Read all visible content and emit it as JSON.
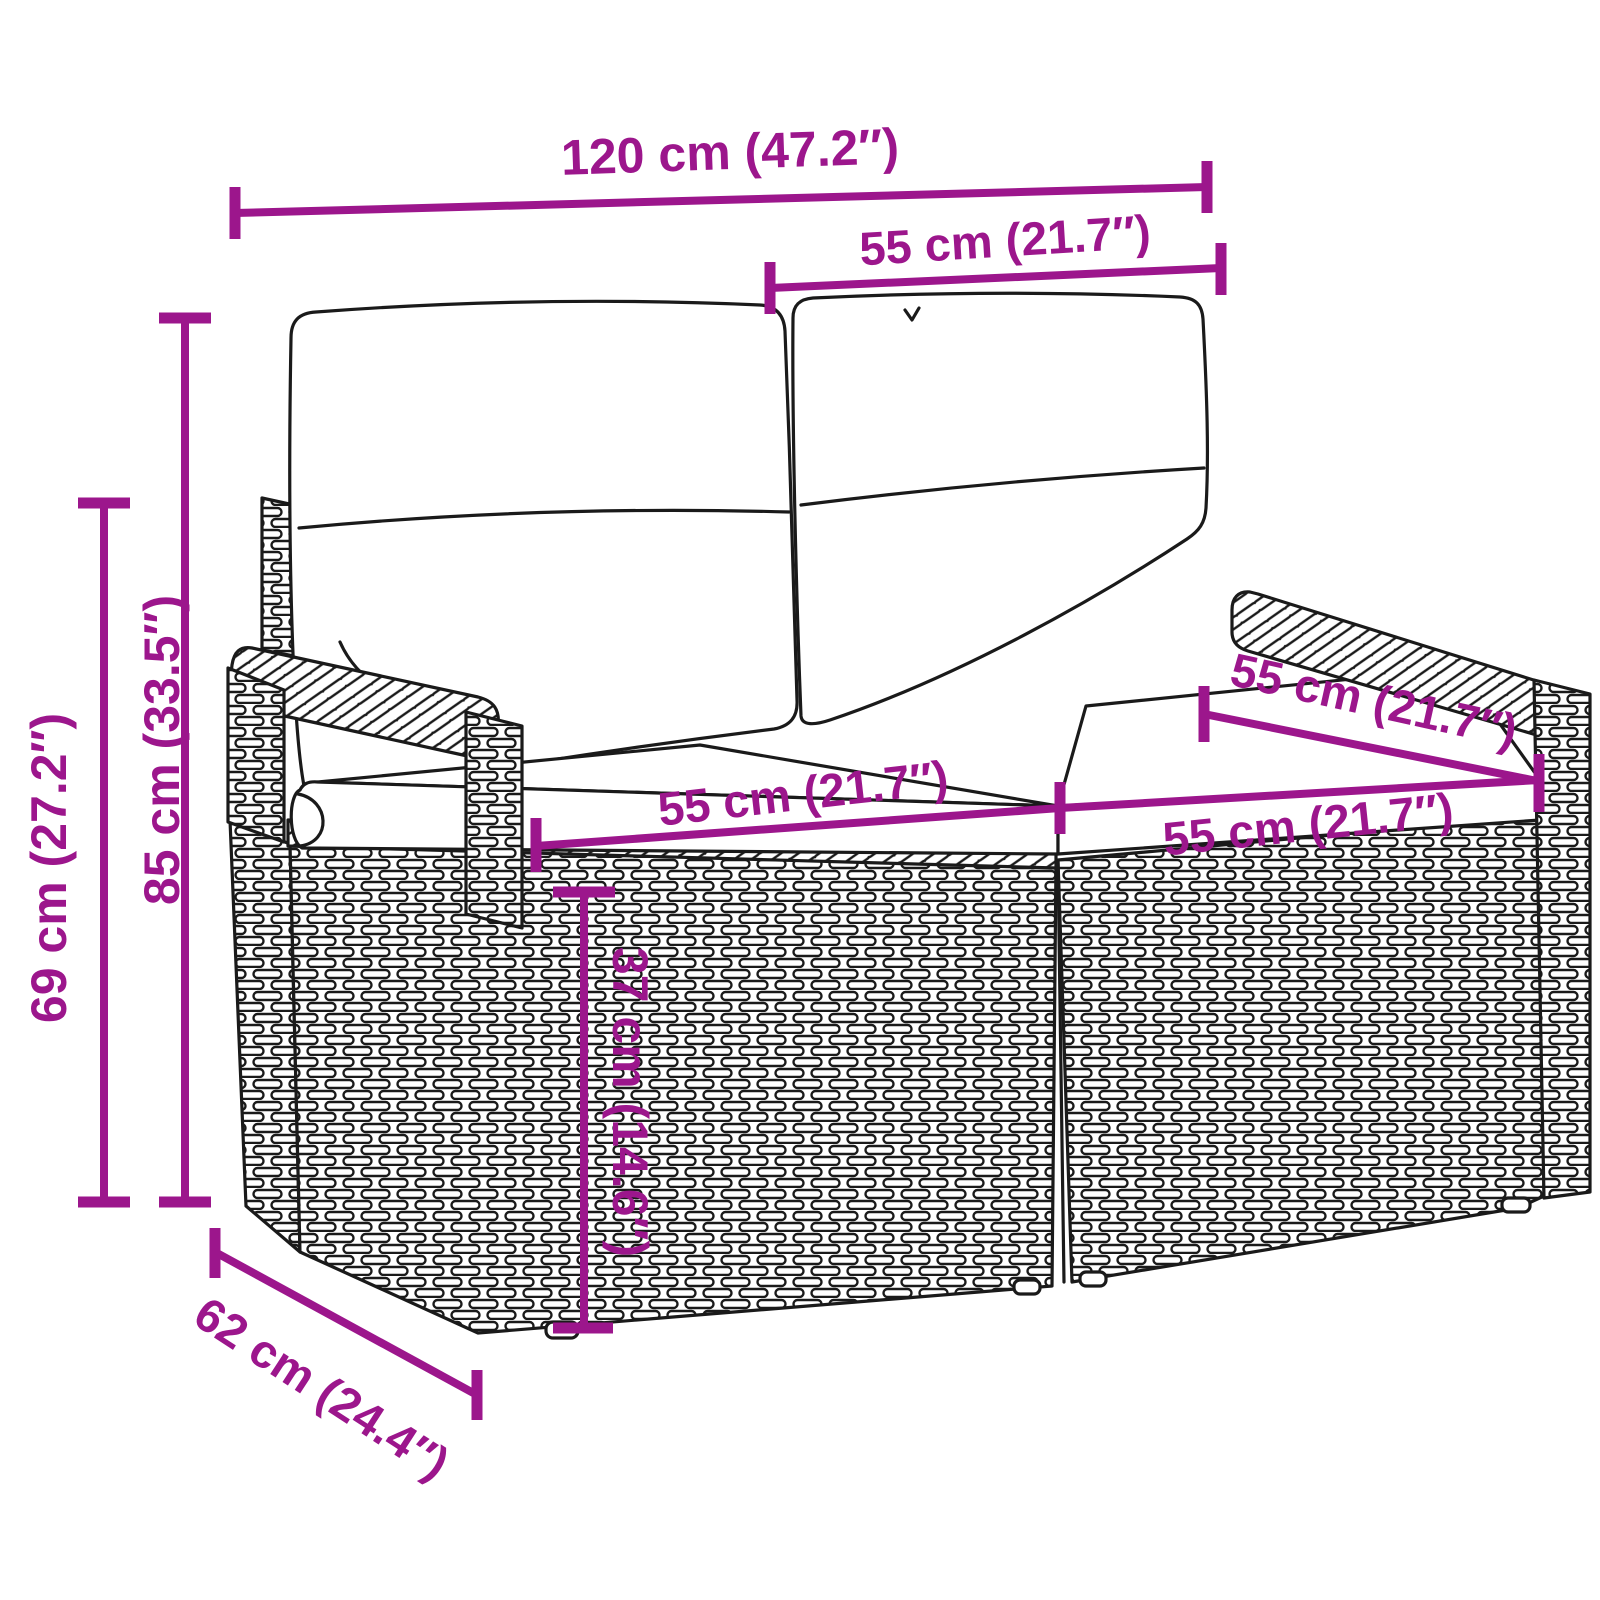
{
  "illustration": {
    "description": "Black line-art drawing of a 2-seater poly rattan garden bench with two back cushions and two seat cushions, woven wicker texture, viewed in three-quarter perspective",
    "style": "product dimension diagram"
  },
  "colors": {
    "dimension": "#9C168C",
    "line_art": "#1A1A1A",
    "background": "#FFFFFF",
    "cushion_fill": "#FFFFFF"
  },
  "dimensions": [
    {
      "id": "overall-width",
      "label": "120 cm (47.2″)"
    },
    {
      "id": "backrest-cushion-width",
      "label": "55 cm (21.7″)"
    },
    {
      "id": "seat-depth-right",
      "label": "55 cm (21.7″)"
    },
    {
      "id": "seat-width-left",
      "label": "55 cm (21.7″)"
    },
    {
      "id": "seat-width-right",
      "label": "55 cm (21.7″)"
    },
    {
      "id": "total-height",
      "label": "85 cm (33.5″)"
    },
    {
      "id": "arm-side-height",
      "label": "69 cm (27.2″)"
    },
    {
      "id": "seat-height",
      "label": "37 cm (14.6″)"
    },
    {
      "id": "overall-depth",
      "label": "62 cm (24.4″)"
    }
  ]
}
